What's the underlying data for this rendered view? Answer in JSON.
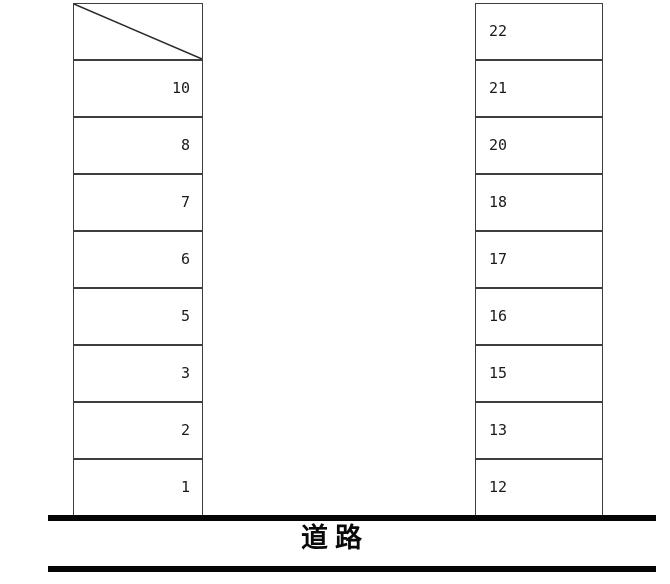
{
  "diagram": {
    "title": "parking-lot-layout",
    "road_label": "道路",
    "left_column": {
      "cells": [
        {
          "label": "",
          "diagonal": true
        },
        {
          "label": "10"
        },
        {
          "label": "8"
        },
        {
          "label": "7"
        },
        {
          "label": "6"
        },
        {
          "label": "5"
        },
        {
          "label": "3"
        },
        {
          "label": "2"
        },
        {
          "label": "1"
        }
      ]
    },
    "right_column": {
      "cells": [
        {
          "label": "22"
        },
        {
          "label": "21"
        },
        {
          "label": "20"
        },
        {
          "label": "18"
        },
        {
          "label": "17"
        },
        {
          "label": "16"
        },
        {
          "label": "15"
        },
        {
          "label": "13"
        },
        {
          "label": "12"
        }
      ]
    },
    "colors": {
      "background": "#ffffff",
      "cell_border": "#3d3d3d",
      "road_line": "#050505",
      "text": "#1a1a1a"
    }
  }
}
